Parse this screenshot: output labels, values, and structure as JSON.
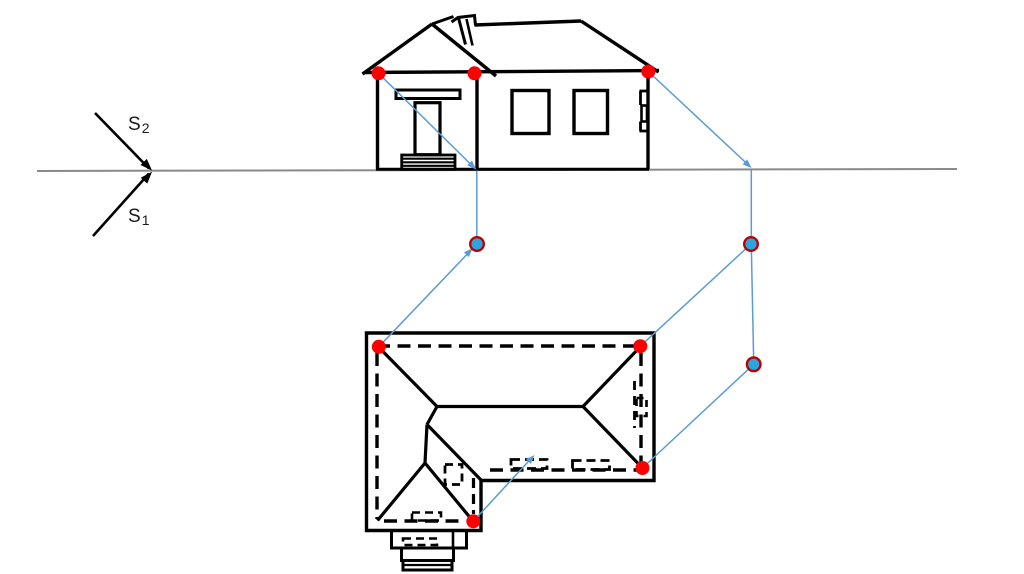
{
  "labels": {
    "s2": {
      "base": "S",
      "sub": "2"
    },
    "s1": {
      "base": "S",
      "sub": "1"
    }
  },
  "colors": {
    "ink": "#000000",
    "horizon": "#8a8a8a",
    "blue": "#5b9bd5",
    "red_dot": "#ff0000",
    "cyan_dot": "#2aa6dc",
    "dot_ring": "#c00000"
  },
  "diagram": {
    "width": 1024,
    "height": 574,
    "shapes": [
      {
        "t": "line",
        "n": "horizon-line",
        "x1": 37,
        "y1": 171,
        "x2": 957,
        "y2": 169,
        "c": "horizon",
        "w": 2
      },
      {
        "t": "line",
        "n": "station-arrow-s2-line",
        "x1": 95,
        "y1": 113,
        "x2": 149,
        "y2": 168.5,
        "c": "ink",
        "w": 2.6
      },
      {
        "t": "line",
        "n": "station-arrow-s1-line",
        "x1": 93,
        "y1": 236,
        "x2": 149,
        "y2": 173.5,
        "c": "ink",
        "w": 2.6
      },
      {
        "t": "arrow",
        "n": "station-arrow-s2-head",
        "x": 152,
        "y": 170.5,
        "a": 45.8,
        "len": 12,
        "hw": 4.4,
        "c": "ink"
      },
      {
        "t": "arrow",
        "n": "station-arrow-s1-head",
        "x": 152,
        "y": 171.8,
        "a": -48.1,
        "len": 12,
        "hw": 4.4,
        "c": "ink"
      },
      {
        "t": "line",
        "n": "elev-eave",
        "x1": 364,
        "y1": 72.5,
        "x2": 659,
        "y2": 70.5,
        "c": "ink",
        "w": 3.4
      },
      {
        "t": "line",
        "n": "elev-gable-left-slope",
        "x1": 432,
        "y1": 24,
        "x2": 362.5,
        "y2": 74,
        "c": "ink",
        "w": 3.4
      },
      {
        "t": "line",
        "n": "elev-gable-right-slope",
        "x1": 432,
        "y1": 24,
        "x2": 496,
        "y2": 76,
        "c": "ink",
        "w": 3.4
      },
      {
        "t": "line",
        "n": "elev-gable-ridge",
        "x1": 432,
        "y1": 24,
        "x2": 453.5,
        "y2": 16.5,
        "c": "ink",
        "w": 3
      },
      {
        "t": "poly",
        "n": "elev-chimney-cap",
        "pts": "451.5,22 458,17.5 474.5,15.5 475.5,25.5",
        "c": "ink",
        "w": 3,
        "closed": false
      },
      {
        "t": "line",
        "n": "elev-chimney-left",
        "x1": 458.5,
        "y1": 18,
        "x2": 465.5,
        "y2": 44.5,
        "c": "ink",
        "w": 3
      },
      {
        "t": "line",
        "n": "elev-chimney-inner",
        "x1": 466.5,
        "y1": 19,
        "x2": 472.5,
        "y2": 45.5,
        "c": "ink",
        "w": 2.6
      },
      {
        "t": "line",
        "n": "elev-main-ridge",
        "x1": 474.5,
        "y1": 25,
        "x2": 581,
        "y2": 21,
        "c": "ink",
        "w": 3.4
      },
      {
        "t": "line",
        "n": "elev-main-right-slope",
        "x1": 581,
        "y1": 21,
        "x2": 658.5,
        "y2": 72,
        "c": "ink",
        "w": 3.4
      },
      {
        "t": "line",
        "n": "elev-wall-left",
        "x1": 377.5,
        "y1": 73.5,
        "x2": 377.5,
        "y2": 169.3,
        "c": "ink",
        "w": 3.4
      },
      {
        "t": "line",
        "n": "elev-wall-porch-right",
        "x1": 477,
        "y1": 74,
        "x2": 477,
        "y2": 169.3,
        "c": "ink",
        "w": 3.4
      },
      {
        "t": "line",
        "n": "elev-wall-right",
        "x1": 648,
        "y1": 72,
        "x2": 648,
        "y2": 169.3,
        "c": "ink",
        "w": 3.4
      },
      {
        "t": "line",
        "n": "elev-base",
        "x1": 376,
        "y1": 169.3,
        "x2": 649,
        "y2": 169.3,
        "c": "ink",
        "w": 3
      },
      {
        "t": "rect",
        "n": "elev-porch-beam",
        "x": 396,
        "y": 90,
        "w": 64,
        "h": 8.5,
        "c": "ink",
        "sw": 3
      },
      {
        "t": "rect",
        "n": "elev-door",
        "x": 415,
        "y": 102.7,
        "w": 25,
        "h": 52,
        "c": "ink",
        "sw": 3.2
      },
      {
        "t": "rect",
        "n": "elev-steps",
        "x": 401.7,
        "y": 155,
        "w": 53.3,
        "h": 14.3,
        "c": "ink",
        "sw": 2.8
      },
      {
        "t": "line",
        "n": "elev-steps-line-1",
        "x1": 401.7,
        "y1": 158.7,
        "x2": 455,
        "y2": 158.7,
        "c": "ink",
        "w": 2.2
      },
      {
        "t": "line",
        "n": "elev-steps-line-2",
        "x1": 401.7,
        "y1": 162.3,
        "x2": 455,
        "y2": 162.3,
        "c": "ink",
        "w": 2.2
      },
      {
        "t": "line",
        "n": "elev-steps-line-3",
        "x1": 401.7,
        "y1": 165.8,
        "x2": 455,
        "y2": 165.8,
        "c": "ink",
        "w": 2.2
      },
      {
        "t": "rect",
        "n": "elev-window-1",
        "x": 512,
        "y": 90.5,
        "w": 37,
        "h": 43,
        "c": "ink",
        "sw": 3.4
      },
      {
        "t": "rect",
        "n": "elev-window-2",
        "x": 574,
        "y": 90.5,
        "w": 33.5,
        "h": 43,
        "c": "ink",
        "sw": 3.4
      },
      {
        "t": "line",
        "n": "elev-side-door-tick-top",
        "x1": 639.5,
        "y1": 91,
        "x2": 648,
        "y2": 91,
        "c": "ink",
        "w": 2.8
      },
      {
        "t": "line",
        "n": "elev-side-door-vert-1",
        "x1": 640.5,
        "y1": 91,
        "x2": 640.5,
        "y2": 105,
        "c": "ink",
        "w": 2.8
      },
      {
        "t": "rect",
        "n": "elev-side-door-handle",
        "x": 641.5,
        "y": 105.5,
        "w": 5.5,
        "h": 16,
        "c": "ink",
        "sw": 2.6
      },
      {
        "t": "line",
        "n": "elev-side-door-vert-2",
        "x1": 640.5,
        "y1": 121.5,
        "x2": 640.5,
        "y2": 131,
        "c": "ink",
        "w": 2.8
      },
      {
        "t": "line",
        "n": "elev-side-door-tick-bottom",
        "x1": 639.5,
        "y1": 131,
        "x2": 648,
        "y2": 131,
        "c": "ink",
        "w": 2.8
      },
      {
        "t": "poly",
        "n": "plan-outline",
        "pts": "366.5,333 654,333 654,480.5 481,480.5 481,530.5 366.5,530.5",
        "c": "ink",
        "w": 3.4,
        "closed": true
      },
      {
        "t": "line",
        "n": "plan-ridge",
        "x1": 437,
        "y1": 406.5,
        "x2": 583,
        "y2": 406.5,
        "c": "ink",
        "w": 3.2
      },
      {
        "t": "line",
        "n": "plan-hip-top-left",
        "x1": 379,
        "y1": 347.5,
        "x2": 437,
        "y2": 406.5,
        "c": "ink",
        "w": 3.2
      },
      {
        "t": "line",
        "n": "plan-hip-top-right",
        "x1": 640,
        "y1": 347,
        "x2": 583,
        "y2": 406.5,
        "c": "ink",
        "w": 3.2
      },
      {
        "t": "line",
        "n": "plan-hip-bottom-right",
        "x1": 642,
        "y1": 467.5,
        "x2": 583,
        "y2": 406.5,
        "c": "ink",
        "w": 3.2
      },
      {
        "t": "line",
        "n": "plan-ridge-connector",
        "x1": 437,
        "y1": 406.5,
        "x2": 427,
        "y2": 424.5,
        "c": "ink",
        "w": 3.2
      },
      {
        "t": "line",
        "n": "plan-wing-ridge",
        "x1": 427,
        "y1": 424.5,
        "x2": 425,
        "y2": 463,
        "c": "ink",
        "w": 3.2
      },
      {
        "t": "line",
        "n": "plan-wing-hip-left",
        "x1": 425,
        "y1": 463,
        "x2": 377.5,
        "y2": 520.5,
        "c": "ink",
        "w": 3.2
      },
      {
        "t": "line",
        "n": "plan-wing-hip-right",
        "x1": 425,
        "y1": 463,
        "x2": 472.5,
        "y2": 520.5,
        "c": "ink",
        "w": 3.2
      },
      {
        "t": "line",
        "n": "plan-valley",
        "x1": 427,
        "y1": 424.5,
        "x2": 481,
        "y2": 480,
        "c": "ink",
        "w": 3.2
      },
      {
        "t": "rect",
        "n": "plan-step-a",
        "x": 391.5,
        "y": 530.5,
        "w": 75,
        "h": 17.5,
        "c": "ink",
        "sw": 3
      },
      {
        "t": "line",
        "n": "plan-step-a-divider",
        "x1": 453,
        "y1": 530.5,
        "x2": 453,
        "y2": 548,
        "c": "ink",
        "w": 2.6
      },
      {
        "t": "rect",
        "n": "plan-step-b",
        "x": 401.5,
        "y": 548,
        "w": 52,
        "h": 12.5,
        "c": "ink",
        "sw": 3
      },
      {
        "t": "rect",
        "n": "plan-step-c",
        "x": 403,
        "y": 560.5,
        "w": 49,
        "h": 9.5,
        "c": "ink",
        "sw": 3
      },
      {
        "t": "line",
        "n": "plan-step-c-divider",
        "x1": 403,
        "y1": 565,
        "x2": 452,
        "y2": 565,
        "c": "ink",
        "w": 2.2
      },
      {
        "t": "line",
        "n": "plan-wall-top-dashed",
        "x1": 377,
        "y1": 346,
        "x2": 641,
        "y2": 346,
        "c": "ink",
        "w": 3.4,
        "d": "13 7.5"
      },
      {
        "t": "line",
        "n": "plan-wall-left-dashed",
        "x1": 377,
        "y1": 353,
        "x2": 377,
        "y2": 519,
        "c": "ink",
        "w": 3.4,
        "d": "13 7.5"
      },
      {
        "t": "line",
        "n": "plan-wall-right-dashed",
        "x1": 641,
        "y1": 353,
        "x2": 641,
        "y2": 462,
        "c": "ink",
        "w": 3.4,
        "d": "13 7.5"
      },
      {
        "t": "line",
        "n": "plan-wall-main-bottom-dashed",
        "x1": 490,
        "y1": 470,
        "x2": 637,
        "y2": 470,
        "c": "ink",
        "w": 3.4,
        "d": "13 7.5"
      },
      {
        "t": "line",
        "n": "plan-wall-wing-bottom-dashed",
        "x1": 384,
        "y1": 521,
        "x2": 466,
        "y2": 521,
        "c": "ink",
        "w": 3.4,
        "d": "13 7.5"
      },
      {
        "t": "line",
        "n": "plan-wall-wing-right-dashed",
        "x1": 473.5,
        "y1": 478,
        "x2": 473.5,
        "y2": 514,
        "c": "ink",
        "w": 3.2,
        "d": "10 6"
      },
      {
        "t": "rect",
        "n": "plan-door-square-dashed",
        "x": 445,
        "y": 464.5,
        "w": 17,
        "h": 20,
        "c": "ink",
        "sw": 2.8,
        "d": "8 5"
      },
      {
        "t": "rect",
        "n": "plan-wing-threshold-dashed",
        "x": 412,
        "y": 512.5,
        "w": 29,
        "h": 8,
        "c": "ink",
        "sw": 2.6,
        "d": "8 5"
      },
      {
        "t": "rect",
        "n": "plan-step-dash-detail",
        "x": 403,
        "y": 538.5,
        "w": 34,
        "h": 6.5,
        "c": "ink",
        "sw": 2.6,
        "d": "8 5"
      },
      {
        "t": "rect",
        "n": "plan-window-1-dashed",
        "x": 511,
        "y": 459.5,
        "w": 36,
        "h": 9,
        "c": "ink",
        "sw": 2.8,
        "d": "9 5"
      },
      {
        "t": "rect",
        "n": "plan-window-2-dashed",
        "x": 572.5,
        "y": 460.5,
        "w": 37,
        "h": 9,
        "c": "ink",
        "sw": 2.8,
        "d": "9 5"
      },
      {
        "t": "line",
        "n": "plan-side-door-dashed",
        "x1": 634.5,
        "y1": 381,
        "x2": 634.5,
        "y2": 428,
        "c": "ink",
        "w": 2.8,
        "d": "9 6"
      },
      {
        "t": "rect",
        "n": "plan-side-door-handle-dashed",
        "x": 636.5,
        "y": 398,
        "w": 10,
        "h": 18,
        "c": "ink",
        "sw": 2.6,
        "d": "7 5"
      },
      {
        "t": "line",
        "n": "proj-elev-left-diagonal",
        "x1": 378.5,
        "y1": 73.3,
        "x2": 475.5,
        "y2": 169,
        "c": "blue",
        "w": 1.5
      },
      {
        "t": "line",
        "n": "proj-left-vertical",
        "x1": 476.8,
        "y1": 170.5,
        "x2": 476.8,
        "y2": 242,
        "c": "blue",
        "w": 1.5
      },
      {
        "t": "line",
        "n": "proj-plan-tl-to-dot",
        "x1": 378.8,
        "y1": 346.8,
        "x2": 474.5,
        "y2": 246.5,
        "c": "blue",
        "w": 1.5
      },
      {
        "t": "line",
        "n": "proj-elev-right-diagonal",
        "x1": 648.3,
        "y1": 71.5,
        "x2": 750,
        "y2": 166.5,
        "c": "blue",
        "w": 1.5
      },
      {
        "t": "line",
        "n": "proj-right-vertical-upper",
        "x1": 751.3,
        "y1": 170,
        "x2": 751.3,
        "y2": 242,
        "c": "blue",
        "w": 1.5
      },
      {
        "t": "line",
        "n": "proj-right-vertical-lower",
        "x1": 751.3,
        "y1": 246,
        "x2": 753.7,
        "y2": 362,
        "c": "blue",
        "w": 1.5
      },
      {
        "t": "line",
        "n": "proj-dot-to-plan-tr",
        "x1": 751,
        "y1": 244,
        "x2": 640.3,
        "y2": 346.2,
        "c": "blue",
        "w": 1.5
      },
      {
        "t": "line",
        "n": "proj-dot-to-plan-br",
        "x1": 753.7,
        "y1": 364.3,
        "x2": 642.5,
        "y2": 468,
        "c": "blue",
        "w": 1.5
      },
      {
        "t": "line",
        "n": "proj-wing-dot-arrow-line",
        "x1": 473.3,
        "y1": 521.3,
        "x2": 532,
        "y2": 457.5,
        "c": "blue",
        "w": 1.5
      },
      {
        "t": "arrow",
        "n": "proj-arrowhead-left-ground",
        "x": 476,
        "y": 169.3,
        "a": 44.6,
        "len": 9,
        "hw": 3.4,
        "c": "blue"
      },
      {
        "t": "arrow",
        "n": "proj-arrowhead-right-horizon",
        "x": 751.5,
        "y": 168,
        "a": 43,
        "len": 9,
        "hw": 3.4,
        "c": "blue"
      },
      {
        "t": "arrow",
        "n": "proj-arrowhead-at-left-dot",
        "x": 472.6,
        "y": 248.2,
        "a": -46.3,
        "len": 9,
        "hw": 3.4,
        "c": "blue"
      },
      {
        "t": "arrow",
        "n": "proj-arrowhead-mid-plan",
        "x": 534.5,
        "y": 455,
        "a": -47.3,
        "len": 9,
        "hw": 3.4,
        "c": "blue"
      },
      {
        "t": "dot",
        "n": "red-dot-elev-left",
        "x": 378.5,
        "y": 73.3,
        "r": 7,
        "f": "red_dot"
      },
      {
        "t": "dot",
        "n": "red-dot-elev-middle",
        "x": 474.5,
        "y": 73.3,
        "r": 7,
        "f": "red_dot"
      },
      {
        "t": "dot",
        "n": "red-dot-elev-right",
        "x": 648.3,
        "y": 71.5,
        "r": 7,
        "f": "red_dot"
      },
      {
        "t": "dot",
        "n": "red-dot-plan-top-left",
        "x": 378.8,
        "y": 346.8,
        "r": 7,
        "f": "red_dot"
      },
      {
        "t": "dot",
        "n": "red-dot-plan-top-right",
        "x": 640.3,
        "y": 346.2,
        "r": 7,
        "f": "red_dot"
      },
      {
        "t": "dot",
        "n": "red-dot-plan-bottom-right",
        "x": 642.5,
        "y": 468,
        "r": 7,
        "f": "red_dot"
      },
      {
        "t": "dot",
        "n": "red-dot-plan-wing",
        "x": 473.3,
        "y": 521.3,
        "r": 7,
        "f": "red_dot"
      },
      {
        "t": "dot",
        "n": "blue-dot-left",
        "x": 477,
        "y": 244,
        "r": 6.8,
        "f": "cyan_dot",
        "s": "dot_ring",
        "sw": 2.4
      },
      {
        "t": "dot",
        "n": "blue-dot-right-upper",
        "x": 751,
        "y": 244,
        "r": 6.8,
        "f": "cyan_dot",
        "s": "dot_ring",
        "sw": 2.4
      },
      {
        "t": "dot",
        "n": "blue-dot-right-lower",
        "x": 753.7,
        "y": 364.3,
        "r": 6.8,
        "f": "cyan_dot",
        "s": "dot_ring",
        "sw": 2.4
      }
    ]
  },
  "label_positions": {
    "s2": {
      "left": 128,
      "top": 115
    },
    "s1": {
      "left": 128,
      "top": 207
    }
  }
}
